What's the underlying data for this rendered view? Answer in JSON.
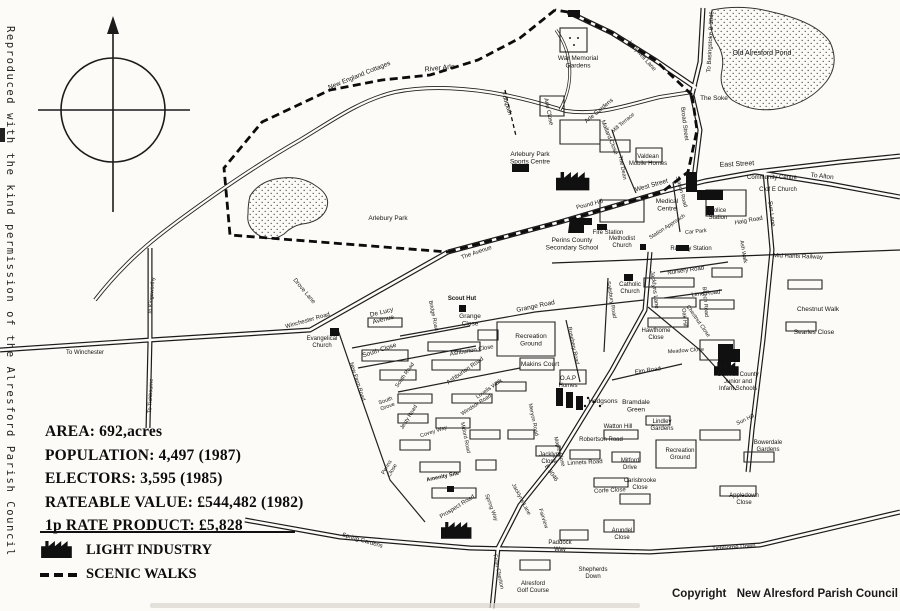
{
  "attribution": {
    "vertical_note": "Reproduced with the kind permission of the Alresford Parish Council",
    "copyright_label": "Copyright",
    "copyright_holder": "New Alresford Parish Council"
  },
  "stats": {
    "lines": [
      "AREA: 692,acres",
      "POPULATION: 4,497 (1987)",
      "ELECTORS: 3,595 (1985)",
      "RATEABLE VALUE: £544,482 (1982)",
      "1p RATE PRODUCT: £5,828"
    ]
  },
  "legend": {
    "items": [
      {
        "icon": "factory-icon",
        "label": "LIGHT INDUSTRY"
      },
      {
        "icon": "scenic-walk-dash-icon",
        "label": "SCENIC WALKS"
      }
    ]
  },
  "map": {
    "ink_color": "#1b1b1b",
    "light_industry_sites": [
      {
        "x": 556,
        "y": 172,
        "scale": 1.15
      },
      {
        "x": 441,
        "y": 522,
        "scale": 1.05
      },
      {
        "x": 714,
        "y": 362,
        "scale": 0.85
      }
    ],
    "labels": [
      {
        "t": "New England Cottages",
        "x": 360,
        "y": 77,
        "r": -22,
        "s": 6.5
      },
      {
        "t": "River Arle",
        "x": 440,
        "y": 70,
        "r": -6,
        "s": 7
      },
      {
        "t": "Footpath",
        "x": 505,
        "y": 104,
        "r": 72,
        "s": 6
      },
      {
        "t": "War Memorial\nGardens",
        "x": 578,
        "y": 60,
        "s": 6.5
      },
      {
        "t": "Arle Close",
        "x": 547,
        "y": 112,
        "r": 78,
        "s": 6
      },
      {
        "t": "Arle Gardens",
        "x": 600,
        "y": 112,
        "r": -40,
        "s": 6
      },
      {
        "t": "Mill Terrace",
        "x": 624,
        "y": 124,
        "r": -40,
        "s": 5.5
      },
      {
        "t": "Mallard Close",
        "x": 608,
        "y": 138,
        "r": 68,
        "s": 6
      },
      {
        "t": "Valdean\nMobile Homes",
        "x": 648,
        "y": 158,
        "s": 6
      },
      {
        "t": "Ladywell Lane",
        "x": 641,
        "y": 57,
        "r": 48,
        "s": 6
      },
      {
        "t": "To Basingstoke B 3046",
        "x": 712,
        "y": 42,
        "r": -87,
        "s": 6
      },
      {
        "t": "Old Alresford Pond",
        "x": 762,
        "y": 55,
        "s": 7
      },
      {
        "t": "The Soke",
        "x": 714,
        "y": 100,
        "s": 6.5
      },
      {
        "t": "Broad Street",
        "x": 683,
        "y": 124,
        "r": 83,
        "s": 6
      },
      {
        "t": "East Street",
        "x": 737,
        "y": 166,
        "r": -3,
        "s": 7
      },
      {
        "t": "To Alton",
        "x": 822,
        "y": 178,
        "r": 6,
        "s": 6.5
      },
      {
        "t": "Community Centre",
        "x": 772,
        "y": 179,
        "s": 6
      },
      {
        "t": "C of E Church",
        "x": 778,
        "y": 191,
        "s": 6
      },
      {
        "t": "Sun Lane",
        "x": 770,
        "y": 214,
        "r": 83,
        "s": 6
      },
      {
        "t": "West Street",
        "x": 652,
        "y": 187,
        "r": -16,
        "s": 6.5
      },
      {
        "t": "Medical\nCentre",
        "x": 667,
        "y": 203,
        "s": 6.5
      },
      {
        "t": "Police\nStation",
        "x": 718,
        "y": 212,
        "s": 6
      },
      {
        "t": "Haig Road",
        "x": 749,
        "y": 222,
        "r": -10,
        "s": 6
      },
      {
        "t": "Fire Station",
        "x": 608,
        "y": 234,
        "s": 6
      },
      {
        "t": "Pound Hill",
        "x": 590,
        "y": 206,
        "r": -14,
        "s": 6
      },
      {
        "t": "Station Approach",
        "x": 668,
        "y": 228,
        "r": -33,
        "s": 5.5
      },
      {
        "t": "Car Park",
        "x": 696,
        "y": 233,
        "r": -5,
        "s": 5.5
      },
      {
        "t": "Methodist\nChurch",
        "x": 622,
        "y": 240,
        "s": 6
      },
      {
        "t": "Railway Station",
        "x": 691,
        "y": 250,
        "s": 6
      },
      {
        "t": "Ash Walk",
        "x": 742,
        "y": 252,
        "r": 80,
        "s": 5.5
      },
      {
        "t": "Mid Hants Railway",
        "x": 798,
        "y": 258,
        "r": 2,
        "s": 6
      },
      {
        "t": "Nursery Road",
        "x": 686,
        "y": 272,
        "r": -8,
        "s": 6
      },
      {
        "t": "Lime Road",
        "x": 706,
        "y": 295,
        "r": -6,
        "s": 6
      },
      {
        "t": "Catholic\nChurch",
        "x": 630,
        "y": 286,
        "s": 6
      },
      {
        "t": "Jacklyns Lane",
        "x": 653,
        "y": 290,
        "r": 83,
        "s": 6
      },
      {
        "t": "Beech Road",
        "x": 704,
        "y": 302,
        "r": 85,
        "s": 5.5
      },
      {
        "t": "Oak Hill",
        "x": 683,
        "y": 318,
        "r": 85,
        "s": 5.5
      },
      {
        "t": "Chestnut Close",
        "x": 697,
        "y": 322,
        "r": 55,
        "s": 5.5
      },
      {
        "t": "Hawthorne\nClose",
        "x": 656,
        "y": 332,
        "s": 6
      },
      {
        "t": "Chestnut Walk",
        "x": 818,
        "y": 311,
        "s": 6.5
      },
      {
        "t": "Searles Close",
        "x": 814,
        "y": 334,
        "s": 6.5
      },
      {
        "t": "Elm Road",
        "x": 648,
        "y": 372,
        "r": -8,
        "s": 6
      },
      {
        "t": "Meadow Close",
        "x": 686,
        "y": 352,
        "r": -4,
        "s": 5.5
      },
      {
        "t": "Sun Hill County\nJunior and\nInfant Schools",
        "x": 738,
        "y": 376,
        "s": 6
      },
      {
        "t": "Salisbury Road",
        "x": 610,
        "y": 300,
        "r": 80,
        "s": 5.5
      },
      {
        "t": "Rosebery Road",
        "x": 572,
        "y": 346,
        "r": 78,
        "s": 5.5
      },
      {
        "t": "Recreation\nGround",
        "x": 531,
        "y": 338,
        "s": 6.5
      },
      {
        "t": "Grange Road",
        "x": 536,
        "y": 308,
        "r": -12,
        "s": 6.5
      },
      {
        "t": "Grange\nClose",
        "x": 470,
        "y": 318,
        "s": 6.5
      },
      {
        "t": "Scout Hut",
        "x": 462,
        "y": 300,
        "s": 6,
        "w": 700
      },
      {
        "t": "Bridge Road",
        "x": 432,
        "y": 316,
        "r": 78,
        "s": 5.5
      },
      {
        "t": "De Lucy\nAvenue",
        "x": 382,
        "y": 314,
        "r": -14,
        "s": 6.5
      },
      {
        "t": "Winchester Road",
        "x": 308,
        "y": 322,
        "r": -16,
        "s": 6
      },
      {
        "t": "Evangelical\nChurch",
        "x": 322,
        "y": 340,
        "s": 6
      },
      {
        "t": "Drove Lane",
        "x": 303,
        "y": 292,
        "r": 50,
        "s": 6
      },
      {
        "t": "To Kingsworthy",
        "x": 153,
        "y": 296,
        "r": -85,
        "s": 5.5
      },
      {
        "t": "To Winchester",
        "x": 85,
        "y": 354,
        "s": 6
      },
      {
        "t": "To Tichbourne",
        "x": 152,
        "y": 396,
        "r": -87,
        "s": 5.5
      },
      {
        "t": "South Close",
        "x": 380,
        "y": 352,
        "r": -18,
        "s": 6.5
      },
      {
        "t": "South Road",
        "x": 406,
        "y": 376,
        "r": -55,
        "s": 5.5
      },
      {
        "t": "New Farm Road",
        "x": 356,
        "y": 382,
        "r": 72,
        "s": 5.5
      },
      {
        "t": "Ashburton Close",
        "x": 472,
        "y": 352,
        "r": -10,
        "s": 6
      },
      {
        "t": "Ashburton Road",
        "x": 466,
        "y": 372,
        "r": -35,
        "s": 6
      },
      {
        "t": "Makins Court",
        "x": 540,
        "y": 366,
        "s": 6.5
      },
      {
        "t": "O.A.P\nHomes",
        "x": 568,
        "y": 380,
        "s": 6
      },
      {
        "t": "Hodgsons",
        "x": 603,
        "y": 403,
        "s": 6.5
      },
      {
        "t": "Bramdale\nGreen",
        "x": 636,
        "y": 404,
        "s": 6.5
      },
      {
        "t": "Watton Hill",
        "x": 618,
        "y": 428,
        "s": 6
      },
      {
        "t": "Robertson Road",
        "x": 601,
        "y": 441,
        "s": 6
      },
      {
        "t": "Lindley\nGardens",
        "x": 662,
        "y": 423,
        "s": 6
      },
      {
        "t": "Recreation\nGround",
        "x": 680,
        "y": 452,
        "s": 6
      },
      {
        "t": "Sun Hill",
        "x": 746,
        "y": 421,
        "r": -25,
        "s": 5.5
      },
      {
        "t": "Bowerdale\nGardens",
        "x": 768,
        "y": 444,
        "s": 6
      },
      {
        "t": "Mitford\nDrive",
        "x": 630,
        "y": 462,
        "s": 6
      },
      {
        "t": "Carisbrooke\nClose",
        "x": 640,
        "y": 482,
        "s": 6
      },
      {
        "t": "Linnets Road",
        "x": 585,
        "y": 464,
        "r": -3,
        "s": 6
      },
      {
        "t": "Maple Close",
        "x": 558,
        "y": 452,
        "r": 75,
        "s": 5.5
      },
      {
        "t": "Corfe Close",
        "x": 610,
        "y": 492,
        "r": -3,
        "s": 6
      },
      {
        "t": "Jacklyn\nClose",
        "x": 549,
        "y": 456,
        "s": 6
      },
      {
        "t": "Meryon Road",
        "x": 532,
        "y": 420,
        "r": 78,
        "s": 5.5
      },
      {
        "t": "B 3046",
        "x": 550,
        "y": 474,
        "r": 55,
        "s": 6
      },
      {
        "t": "Jacklyns Lane",
        "x": 520,
        "y": 500,
        "r": 62,
        "s": 5.5
      },
      {
        "t": "Spring Way",
        "x": 490,
        "y": 508,
        "r": 70,
        "s": 5.5
      },
      {
        "t": "Fairview",
        "x": 542,
        "y": 519,
        "r": 72,
        "s": 5.5
      },
      {
        "t": "Paddock\nWay",
        "x": 560,
        "y": 544,
        "s": 6
      },
      {
        "t": "Arundel\nClose",
        "x": 622,
        "y": 532,
        "s": 6
      },
      {
        "t": "Appledown\nClose",
        "x": 744,
        "y": 497,
        "s": 6
      },
      {
        "t": "Tichborne Down",
        "x": 734,
        "y": 549,
        "r": -4,
        "s": 6
      },
      {
        "t": "Shepherds\nDown",
        "x": 593,
        "y": 571,
        "s": 6
      },
      {
        "t": "Alresford\nGolf Course",
        "x": 533,
        "y": 585,
        "s": 6
      },
      {
        "t": "From Cheriton",
        "x": 497,
        "y": 572,
        "r": 78,
        "s": 5.5
      },
      {
        "t": "Spring Gardens",
        "x": 362,
        "y": 542,
        "r": 16,
        "s": 6
      },
      {
        "t": "Perins\nClose",
        "x": 388,
        "y": 468,
        "r": -60,
        "s": 5.5
      },
      {
        "t": "Amenity Site",
        "x": 443,
        "y": 478,
        "r": -12,
        "s": 5.5,
        "w": 700
      },
      {
        "t": "Prospect Road",
        "x": 458,
        "y": 508,
        "r": -32,
        "s": 6
      },
      {
        "t": "Mitford Road",
        "x": 464,
        "y": 438,
        "r": 78,
        "s": 5.5
      },
      {
        "t": "Covey Way",
        "x": 434,
        "y": 433,
        "r": -18,
        "s": 5.5
      },
      {
        "t": "Jesty Road",
        "x": 410,
        "y": 418,
        "r": -58,
        "s": 5.5
      },
      {
        "t": "South\nGrove",
        "x": 386,
        "y": 402,
        "r": -20,
        "s": 5.5
      },
      {
        "t": "Windsor Road",
        "x": 477,
        "y": 406,
        "r": -33,
        "s": 5.5
      },
      {
        "t": "Lovells Walk",
        "x": 490,
        "y": 390,
        "r": -35,
        "s": 5.5
      },
      {
        "t": "Arlebury Park",
        "x": 388,
        "y": 220,
        "s": 6.5
      },
      {
        "t": "Arlebury Park\nSports Centre",
        "x": 530,
        "y": 156,
        "s": 6.5
      },
      {
        "t": "The Avenue",
        "x": 477,
        "y": 254,
        "r": -19,
        "s": 6
      },
      {
        "t": "Perins County\nSecondary School",
        "x": 572,
        "y": 242,
        "s": 6.5
      },
      {
        "t": "The Dean",
        "x": 621,
        "y": 168,
        "r": 78,
        "s": 5.5
      },
      {
        "t": "Station Road",
        "x": 680,
        "y": 192,
        "r": 75,
        "s": 5.5
      }
    ]
  }
}
